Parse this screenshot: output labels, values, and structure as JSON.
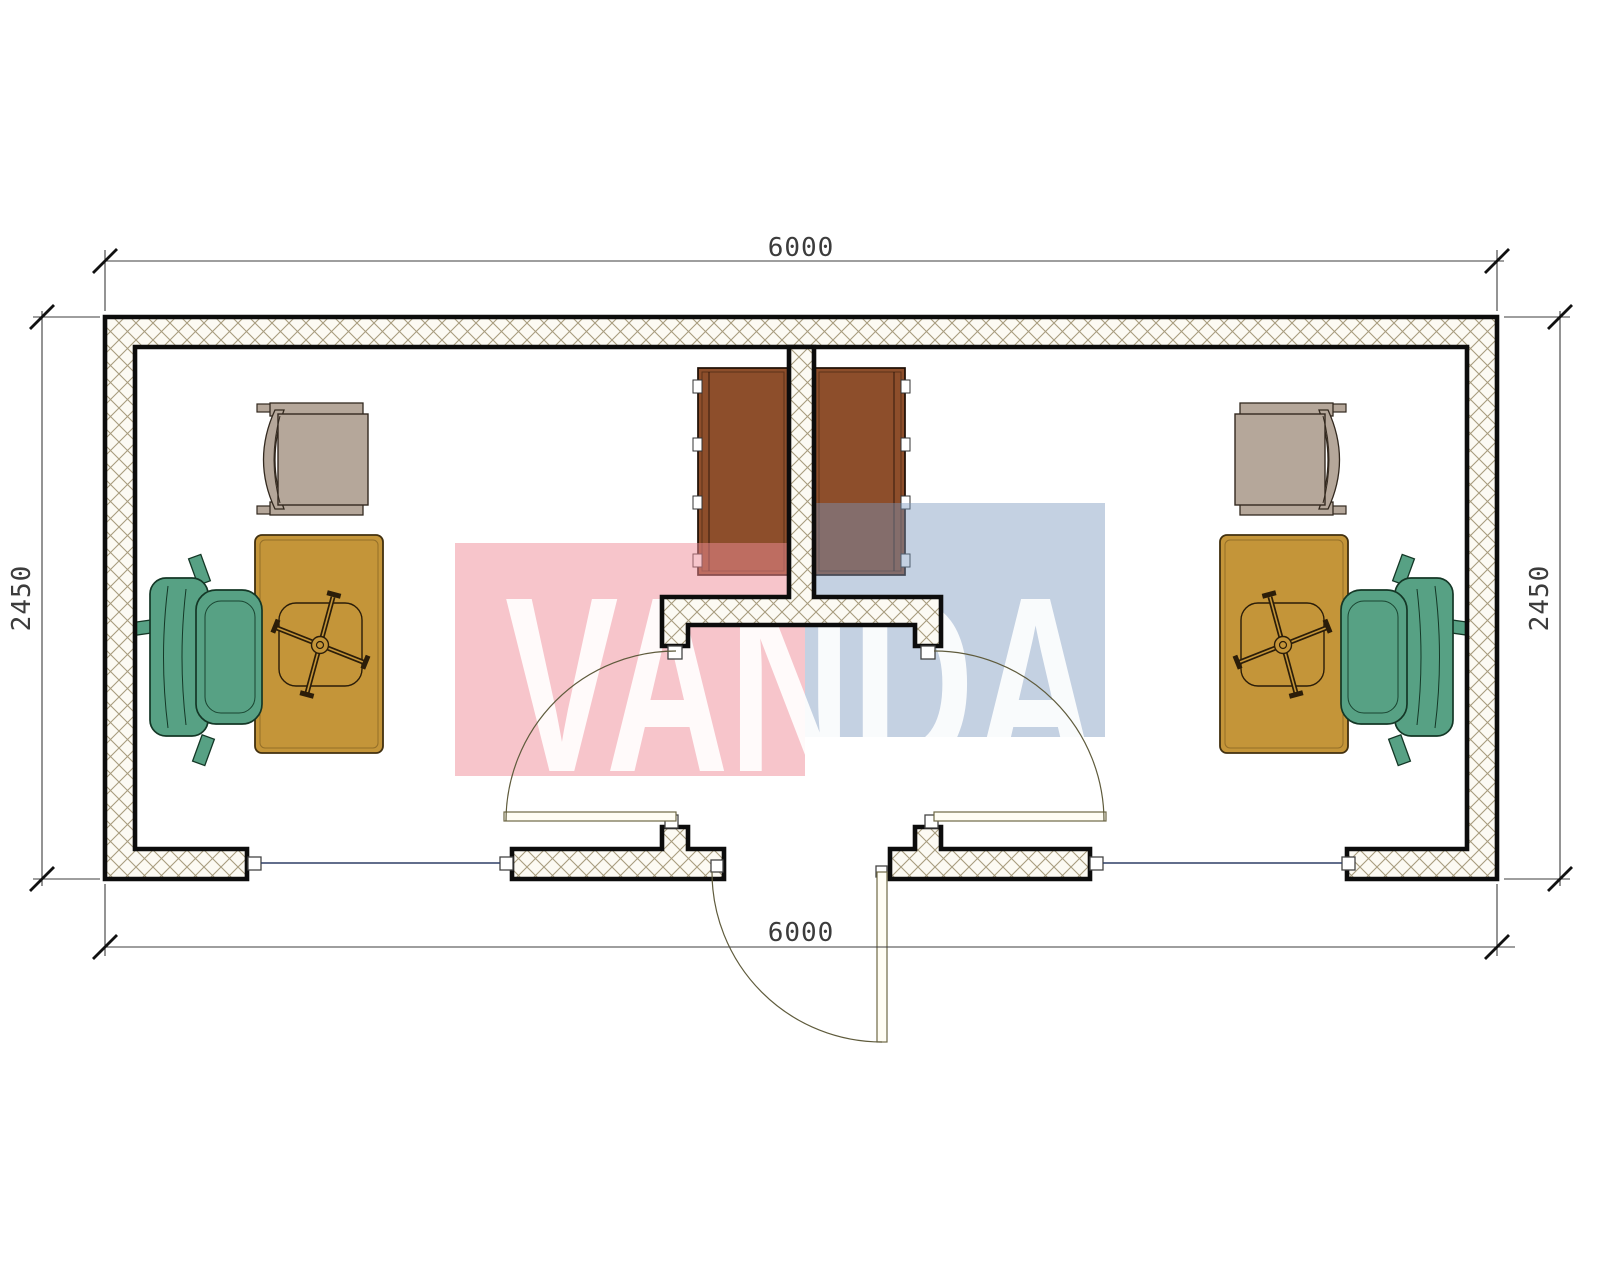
{
  "plan": {
    "dimensions": {
      "width_top": "6000",
      "width_bottom": "6000",
      "height_left": "2450",
      "height_right": "2450"
    },
    "watermark": {
      "text": "VANDA",
      "pink_block": "#f6c9cf",
      "blue_block": "#c5d2e3",
      "letter_color": "#ffffff"
    },
    "colors": {
      "desk": "#c49539",
      "office_chair_green": "#57a184",
      "visitor_chair_beige": "#b5a79a",
      "cabinet_brown": "#8d4e2b",
      "wall_line": "#0c0c0c",
      "hatch_line": "#a89c7e",
      "hatch_bg": "#fcfaf3",
      "window_line": "#2e3f66",
      "door_swing_line": "#6e6845",
      "dimension_line": "#3c3c3c"
    }
  }
}
